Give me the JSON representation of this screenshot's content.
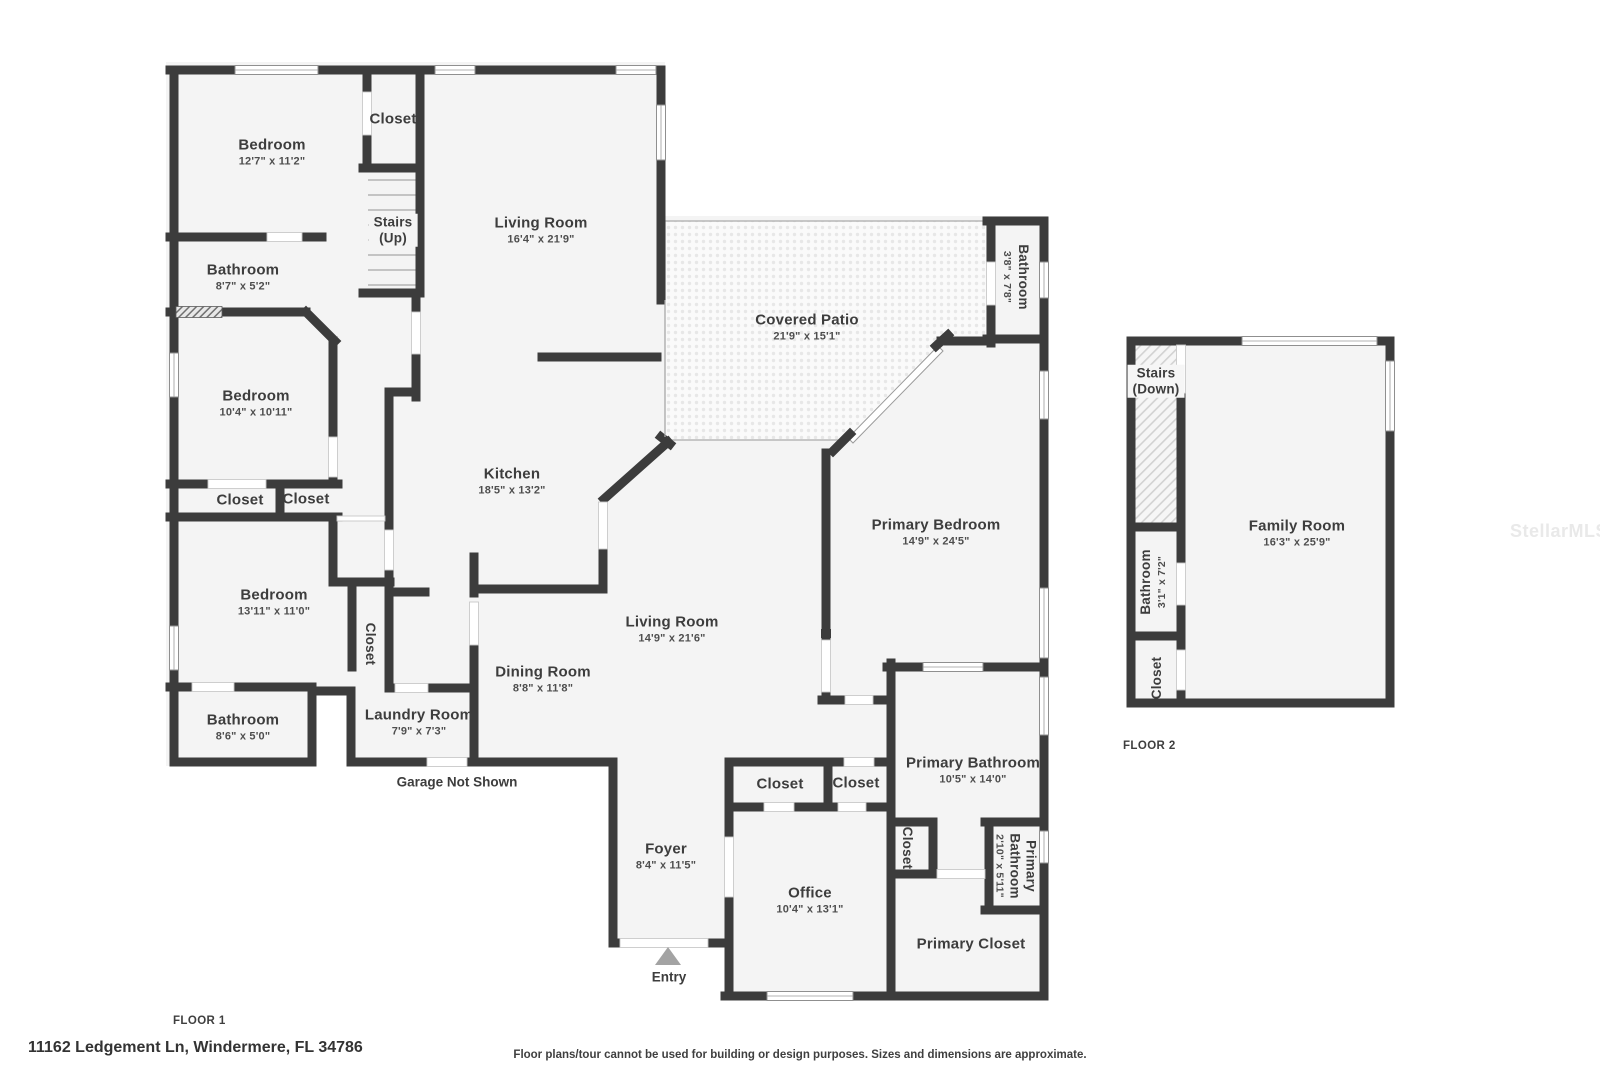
{
  "texts": {
    "floor1_label": "FLOOR 1",
    "floor2_label": "FLOOR 2",
    "address": "11162 Ledgement Ln, Windermere, FL 34786",
    "disclaimer": "Floor plans/tour cannot be used for building or design purposes. Sizes and dimensions are approximate.",
    "garage_note": "Garage Not Shown",
    "entry": "Entry",
    "watermark": "StellarMLS"
  },
  "colors": {
    "wall": "#3c3c3c",
    "room_fill": "#f4f4f4",
    "patio_dot": "#e7e7e7",
    "entry_marker": "#a3a3a3"
  },
  "floor1": {
    "bedroom1": {
      "name": "Bedroom",
      "dims": "12'7\" x 11'2\""
    },
    "closet_top": {
      "name": "Closet"
    },
    "stairs": {
      "name": "Stairs",
      "sub": "(Up)"
    },
    "living1": {
      "name": "Living Room",
      "dims": "16'4\" x 21'9\""
    },
    "bath1": {
      "name": "Bathroom",
      "dims": "8'7\" x 5'2\""
    },
    "bedroom2": {
      "name": "Bedroom",
      "dims": "10'4\" x 10'11\""
    },
    "closet_a": {
      "name": "Closet"
    },
    "closet_b": {
      "name": "Closet"
    },
    "bedroom3": {
      "name": "Bedroom",
      "dims": "13'11\" x 11'0\""
    },
    "bath2": {
      "name": "Bathroom",
      "dims": "8'6\" x 5'0\""
    },
    "closet_hall": {
      "name": "Closet"
    },
    "laundry": {
      "name": "Laundry Room",
      "dims": "7'9\" x 7'3\""
    },
    "kitchen": {
      "name": "Kitchen",
      "dims": "18'5\" x 13'2\""
    },
    "dining": {
      "name": "Dining Room",
      "dims": "8'8\" x 11'8\""
    },
    "patio": {
      "name": "Covered Patio",
      "dims": "21'9\" x 15'1\""
    },
    "bath3": {
      "name": "Bathroom",
      "dims": "3'8\" x 7'8\""
    },
    "primary_bedroom": {
      "name": "Primary Bedroom",
      "dims": "14'9\" x 24'5\""
    },
    "living2": {
      "name": "Living Room",
      "dims": "14'9\" x 21'6\""
    },
    "foyer": {
      "name": "Foyer",
      "dims": "8'4\" x 11'5\""
    },
    "closet_c": {
      "name": "Closet"
    },
    "closet_d": {
      "name": "Closet"
    },
    "primary_bath": {
      "name": "Primary Bathroom",
      "dims": "10'5\" x 14'0\""
    },
    "closet_e": {
      "name": "Closet"
    },
    "primary_bath2": {
      "name": "Primary Bathroom",
      "dims": "2'10\" x 5'11\""
    },
    "office": {
      "name": "Office",
      "dims": "10'4\" x 13'1\""
    },
    "primary_closet": {
      "name": "Primary Closet"
    }
  },
  "floor2": {
    "stairs": {
      "name": "Stairs",
      "sub": "(Down)"
    },
    "bath": {
      "name": "Bathroom",
      "dims": "3'1\" x 7'2\""
    },
    "closet": {
      "name": "Closet"
    },
    "family": {
      "name": "Family Room",
      "dims": "16'3\" x 25'9\""
    }
  }
}
